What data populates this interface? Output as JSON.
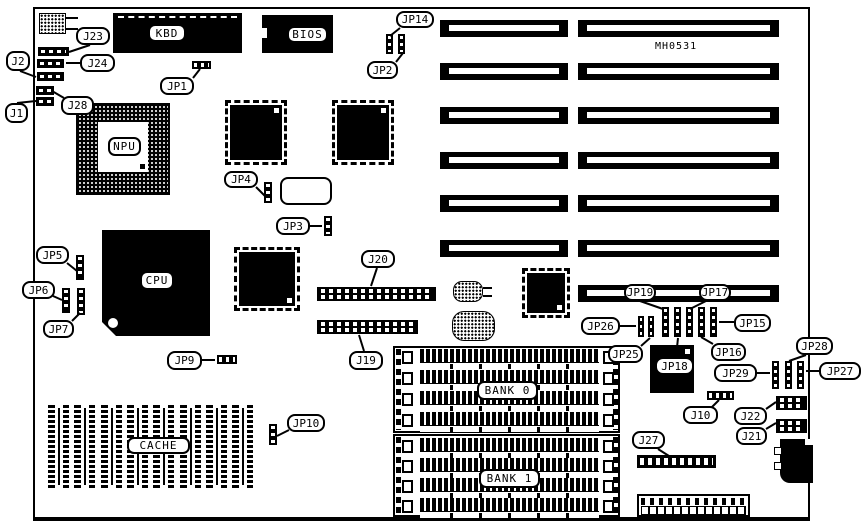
{
  "diagram": {
    "model": "MH0531",
    "ink": "#000000",
    "background": "#ffffff"
  },
  "chip_labels": {
    "kbd": "KBD",
    "bios": "BIOS",
    "npu": "NPU",
    "cpu": "CPU",
    "cache": "CACHE",
    "bank0": "BANK 0",
    "bank1": "BANK 1"
  },
  "layout": {
    "callouts": [
      {
        "label": "J23",
        "x": 76,
        "y": 27,
        "w": 34,
        "h": 18,
        "tail": [
          90,
          45,
          69,
          52
        ]
      },
      {
        "label": "J24",
        "x": 80,
        "y": 54,
        "w": 35,
        "h": 18,
        "tail": [
          80,
          63,
          66,
          63
        ]
      },
      {
        "label": "J2",
        "x": 6,
        "y": 51,
        "w": 24,
        "h": 20,
        "tail": [
          20,
          71,
          36,
          77
        ]
      },
      {
        "label": "J28",
        "x": 61,
        "y": 96,
        "w": 33,
        "h": 19,
        "tail": [
          64,
          98,
          52,
          91
        ]
      },
      {
        "label": "J1",
        "x": 5,
        "y": 103,
        "w": 23,
        "h": 20,
        "tail": [
          17,
          103,
          36,
          101
        ]
      },
      {
        "label": "JP1",
        "x": 160,
        "y": 77,
        "w": 34,
        "h": 18,
        "tail": [
          193,
          78,
          200,
          69
        ]
      },
      {
        "label": "JP14",
        "x": 396,
        "y": 11,
        "w": 38,
        "h": 17,
        "tail": [
          400,
          28,
          390,
          36
        ]
      },
      {
        "label": "JP2",
        "x": 367,
        "y": 61,
        "w": 31,
        "h": 18,
        "tail": [
          396,
          62,
          403,
          53
        ]
      },
      {
        "label": "JP4",
        "x": 224,
        "y": 171,
        "w": 34,
        "h": 17,
        "tail": [
          256,
          187,
          266,
          197
        ]
      },
      {
        "label": "JP3",
        "x": 276,
        "y": 217,
        "w": 34,
        "h": 18,
        "tail": [
          310,
          226,
          322,
          226
        ]
      },
      {
        "label": "JP5",
        "x": 36,
        "y": 246,
        "w": 33,
        "h": 18,
        "tail": [
          67,
          263,
          77,
          271
        ]
      },
      {
        "label": "JP6",
        "x": 22,
        "y": 281,
        "w": 33,
        "h": 18,
        "tail": [
          53,
          296,
          62,
          300
        ]
      },
      {
        "label": "JP7",
        "x": 43,
        "y": 320,
        "w": 31,
        "h": 18,
        "tail": [
          72,
          321,
          80,
          313
        ]
      },
      {
        "label": "JP9",
        "x": 167,
        "y": 351,
        "w": 35,
        "h": 19,
        "tail": [
          202,
          360,
          215,
          360
        ]
      },
      {
        "label": "J20",
        "x": 361,
        "y": 250,
        "w": 34,
        "h": 18,
        "tail": [
          377,
          268,
          371,
          286
        ]
      },
      {
        "label": "J19",
        "x": 349,
        "y": 351,
        "w": 34,
        "h": 19,
        "tail": [
          364,
          351,
          359,
          335
        ]
      },
      {
        "label": "JP10",
        "x": 287,
        "y": 414,
        "w": 38,
        "h": 18,
        "tail": [
          289,
          430,
          277,
          436
        ]
      },
      {
        "label": "JP19",
        "x": 624,
        "y": 284,
        "w": 32,
        "h": 17,
        "tail": [
          640,
          301,
          663,
          309
        ]
      },
      {
        "label": "JP17",
        "x": 699,
        "y": 284,
        "w": 32,
        "h": 17,
        "tail": [
          706,
          301,
          690,
          309
        ]
      },
      {
        "label": "JP15",
        "x": 734,
        "y": 314,
        "w": 37,
        "h": 18,
        "tail": [
          734,
          322,
          719,
          322
        ]
      },
      {
        "label": "JP16",
        "x": 711,
        "y": 343,
        "w": 35,
        "h": 18,
        "tail": [
          713,
          344,
          701,
          337
        ]
      },
      {
        "label": "JP18",
        "x": 655,
        "y": 357,
        "w": 39,
        "h": 18,
        "tail": [
          676,
          357,
          678,
          338
        ]
      },
      {
        "label": "JP26",
        "x": 581,
        "y": 317,
        "w": 39,
        "h": 18,
        "tail": [
          620,
          326,
          636,
          326
        ]
      },
      {
        "label": "JP25",
        "x": 608,
        "y": 345,
        "w": 35,
        "h": 18,
        "tail": [
          641,
          346,
          650,
          338
        ]
      },
      {
        "label": "JP28",
        "x": 796,
        "y": 337,
        "w": 37,
        "h": 18,
        "tail": [
          806,
          355,
          789,
          361
        ]
      },
      {
        "label": "JP29",
        "x": 714,
        "y": 364,
        "w": 43,
        "h": 18,
        "tail": [
          757,
          373,
          770,
          373
        ]
      },
      {
        "label": "JP27",
        "x": 819,
        "y": 362,
        "w": 42,
        "h": 18,
        "tail": [
          819,
          371,
          806,
          371
        ]
      },
      {
        "label": "J10",
        "x": 683,
        "y": 406,
        "w": 35,
        "h": 18,
        "tail": [
          712,
          407,
          719,
          400
        ]
      },
      {
        "label": "J22",
        "x": 734,
        "y": 407,
        "w": 33,
        "h": 18,
        "tail": [
          766,
          409,
          776,
          402
        ]
      },
      {
        "label": "J21",
        "x": 736,
        "y": 427,
        "w": 31,
        "h": 18,
        "tail": [
          766,
          429,
          776,
          423
        ]
      },
      {
        "label": "J27",
        "x": 632,
        "y": 431,
        "w": 33,
        "h": 18,
        "tail": [
          658,
          449,
          669,
          456
        ]
      }
    ],
    "slots": {
      "left": {
        "x": 440,
        "w": 128,
        "h": 17,
        "ys": [
          20,
          63,
          107,
          152,
          195,
          240
        ]
      },
      "right": {
        "x": 578,
        "w": 201,
        "h": 17,
        "ys": [
          20,
          63,
          107,
          152,
          195,
          240,
          285
        ]
      }
    },
    "jumpers": [
      {
        "id": "jp14-a",
        "type": "pv",
        "x": 386,
        "y": 34,
        "w": 7,
        "h": 20
      },
      {
        "id": "jp14-b",
        "type": "pv",
        "x": 398,
        "y": 34,
        "w": 7,
        "h": 20
      },
      {
        "id": "jp4",
        "type": "pv",
        "x": 264,
        "y": 182,
        "w": 8,
        "h": 21
      },
      {
        "id": "jp3",
        "type": "pv",
        "x": 324,
        "y": 216,
        "w": 8,
        "h": 20
      },
      {
        "id": "jp5",
        "type": "pv",
        "x": 76,
        "y": 255,
        "w": 8,
        "h": 25
      },
      {
        "id": "jp6",
        "type": "pv",
        "x": 62,
        "y": 288,
        "w": 8,
        "h": 25
      },
      {
        "id": "jp7",
        "type": "pv",
        "x": 77,
        "y": 288,
        "w": 8,
        "h": 27
      },
      {
        "id": "jp10",
        "type": "pv",
        "x": 269,
        "y": 424,
        "w": 8,
        "h": 21
      },
      {
        "id": "jp19",
        "type": "pv",
        "x": 662,
        "y": 307,
        "w": 7,
        "h": 30
      },
      {
        "id": "jp18",
        "type": "pv",
        "x": 674,
        "y": 307,
        "w": 7,
        "h": 30
      },
      {
        "id": "jp17",
        "type": "pv",
        "x": 686,
        "y": 307,
        "w": 7,
        "h": 30
      },
      {
        "id": "jp16",
        "type": "pv",
        "x": 698,
        "y": 307,
        "w": 7,
        "h": 30
      },
      {
        "id": "jp15",
        "type": "pv",
        "x": 710,
        "y": 307,
        "w": 7,
        "h": 30
      },
      {
        "id": "jp26",
        "type": "pv",
        "x": 638,
        "y": 316,
        "w": 6,
        "h": 21
      },
      {
        "id": "jp25",
        "type": "pv",
        "x": 648,
        "y": 316,
        "w": 6,
        "h": 21
      },
      {
        "id": "jp29",
        "type": "pv",
        "x": 772,
        "y": 361,
        "w": 7,
        "h": 28
      },
      {
        "id": "jp28",
        "type": "pv",
        "x": 785,
        "y": 361,
        "w": 7,
        "h": 28
      },
      {
        "id": "jp27",
        "type": "pv",
        "x": 797,
        "y": 361,
        "w": 7,
        "h": 28
      },
      {
        "id": "jp1",
        "type": "ph",
        "x": 192,
        "y": 61,
        "w": 19,
        "h": 8
      },
      {
        "id": "jp9",
        "type": "ph",
        "x": 217,
        "y": 355,
        "w": 20,
        "h": 9
      },
      {
        "id": "j10",
        "type": "ph",
        "x": 707,
        "y": 391,
        "w": 27,
        "h": 9
      }
    ],
    "headers": [
      {
        "id": "j23",
        "type": "hdr1",
        "x": 38,
        "y": 47,
        "w": 31,
        "h": 9
      },
      {
        "id": "j24",
        "type": "hdr1",
        "x": 37,
        "y": 59,
        "w": 27,
        "h": 9
      },
      {
        "id": "j2",
        "type": "hdr1",
        "x": 37,
        "y": 72,
        "w": 27,
        "h": 9
      },
      {
        "id": "j28",
        "type": "hdr1",
        "x": 36,
        "y": 86,
        "w": 18,
        "h": 9
      },
      {
        "id": "j1",
        "type": "hdr1",
        "x": 36,
        "y": 97,
        "w": 18,
        "h": 9
      },
      {
        "id": "j20",
        "type": "hdr2",
        "x": 317,
        "y": 287,
        "w": 119,
        "h": 14
      },
      {
        "id": "j19",
        "type": "hdr2",
        "x": 317,
        "y": 320,
        "w": 101,
        "h": 14
      },
      {
        "id": "j22",
        "type": "hdr2",
        "x": 776,
        "y": 396,
        "w": 31,
        "h": 14
      },
      {
        "id": "j21",
        "type": "hdr2",
        "x": 776,
        "y": 419,
        "w": 31,
        "h": 14
      },
      {
        "id": "j27",
        "type": "hdr1",
        "x": 637,
        "y": 455,
        "w": 79,
        "h": 13
      }
    ],
    "banks": [
      {
        "id": "bank0",
        "x": 393,
        "y": 346,
        "w": 227,
        "h": 87,
        "rows": [
          349,
          370,
          391,
          412
        ]
      },
      {
        "id": "bank1",
        "x": 393,
        "y": 434,
        "w": 227,
        "h": 83,
        "rows": [
          438,
          458,
          478,
          498
        ]
      }
    ],
    "simm": {
      "x": 420,
      "w": 179,
      "h": 20,
      "clip_left": 402,
      "clip_right": 603,
      "col_left": 396,
      "col_right": 613
    },
    "cache": {
      "x0": 48,
      "y": 405,
      "w": 21,
      "h": 83,
      "count": 8,
      "pitch": 26.3
    },
    "extra_lines": [
      [
        66,
        18,
        78,
        18
      ],
      [
        66,
        29,
        78,
        29
      ],
      [
        483,
        288,
        492,
        288
      ],
      [
        483,
        296,
        492,
        296
      ]
    ]
  }
}
